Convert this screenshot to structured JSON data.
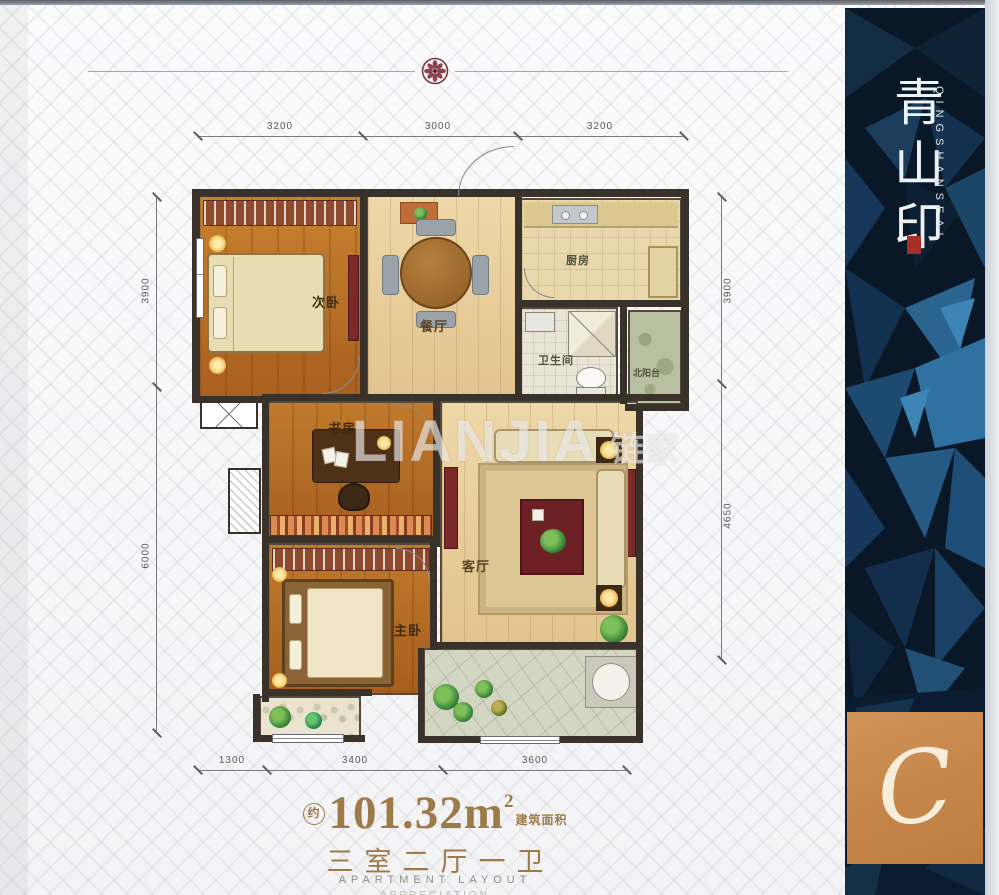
{
  "plan": {
    "rooms": [
      {
        "id": "secondary-bedroom",
        "label": "次卧"
      },
      {
        "id": "dining-room",
        "label": "餐厅"
      },
      {
        "id": "kitchen",
        "label": "厨房"
      },
      {
        "id": "bathroom",
        "label": "卫生间"
      },
      {
        "id": "north-balcony",
        "label": "北阳台"
      },
      {
        "id": "study",
        "label": "书房"
      },
      {
        "id": "living-room",
        "label": "客厅"
      },
      {
        "id": "master-bedroom",
        "label": "主卧"
      }
    ],
    "dimensions": {
      "top": [
        "3200",
        "3000",
        "3200"
      ],
      "bottom": [
        "1300",
        "3400",
        "3600"
      ],
      "left": [
        "3900",
        "6000"
      ],
      "right": [
        "3900",
        "4650"
      ]
    }
  },
  "watermark": {
    "en": "LIANJIA",
    "cn": "链家"
  },
  "sidebar": {
    "brand_cn": "青山印",
    "brand_en": "QINGSHANSEAL",
    "monogram": "C"
  },
  "footer": {
    "approx": "约",
    "area_value": "101.32",
    "area_unit": "m",
    "area_exp": "2",
    "area_label": "建筑面积",
    "layout_cn": "三室二厅一卫",
    "layout_en": "APARTMENT LAYOUT",
    "layout_en_secondary": "APPRECIATION"
  },
  "colors": {
    "accent_gold": "#9d7b49",
    "wall": "#39322b",
    "panel_navy": "#0a1726",
    "panel_orange": "#c8884e",
    "seal_red": "#a52f24"
  }
}
